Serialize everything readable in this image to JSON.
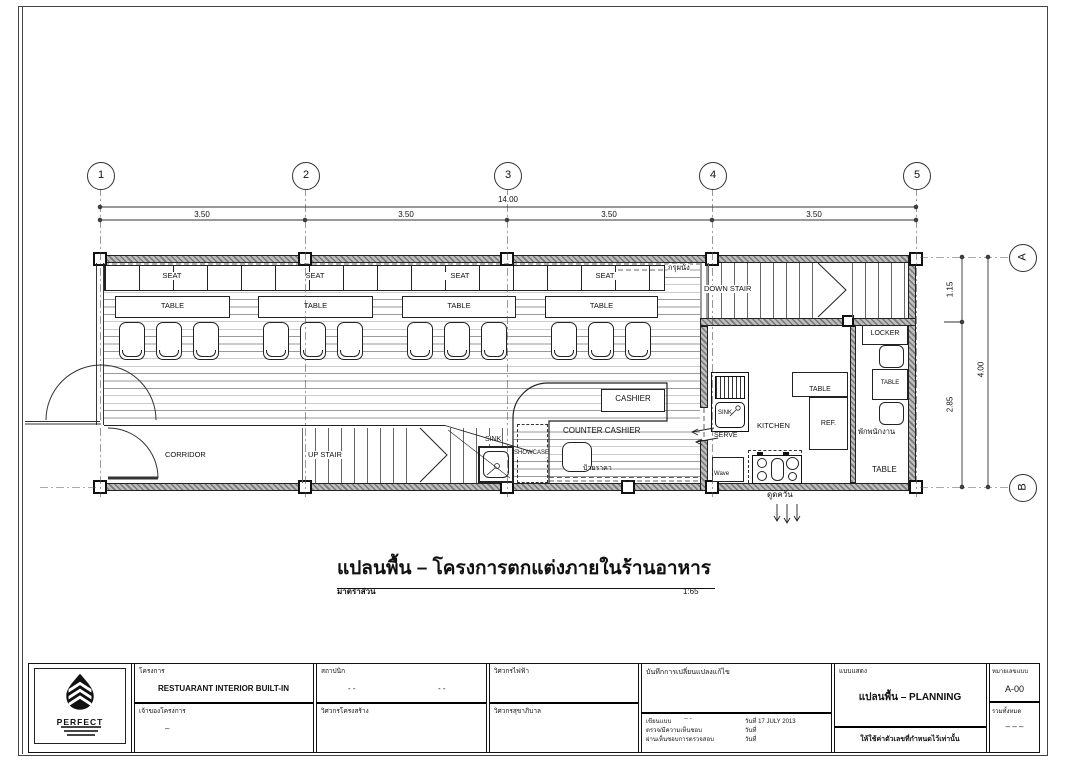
{
  "grid": {
    "cols": [
      "1",
      "2",
      "3",
      "4",
      "5"
    ],
    "rows": [
      "A",
      "B"
    ],
    "dim_total_h": "14.00",
    "dim_segments_h": [
      "3.50",
      "3.50",
      "3.50",
      "3.50"
    ],
    "dim_total_v": "4.00",
    "dim_segments_v": [
      "1.15",
      "2.85"
    ]
  },
  "plan": {
    "labels": {
      "seat": "SEAT",
      "table": "TABLE",
      "corridor": "CORRIDOR",
      "up_stair": "UP STAIR",
      "down_stair": "DOWN STAIR",
      "cashier": "CASHIER",
      "counter_cashier": "COUNTER CASHIER",
      "sink": "SINK",
      "showcase": "SHOWCASE",
      "price_sign": "ป้ายราคา",
      "wall_cladding": "กรุผนัง",
      "kitchen": "KITCHEN",
      "ref": "REF.",
      "serve": "SERVE",
      "microwave": "Wave",
      "exhaust": "ดูดควัน",
      "locker": "LOCKER",
      "staff_room": "พักพนักงาน"
    }
  },
  "caption": {
    "title": "แปลนพื้น –  โครงการตกแต่งภายในร้านอาหาร",
    "scale_label": "มาตราส่วน",
    "scale_value": "1:65"
  },
  "titleblock": {
    "logo_text": "PERFECT",
    "project_label": "โครงการ",
    "project_value": "RESTUARANT INTERIOR BUILT-IN",
    "owner_label": "เจ้าของโครงการ",
    "owner_value": "–",
    "architect_label": "สถาปนิก",
    "architect_value": "- -",
    "architect_value2": "- -",
    "structural_label": "วิศวกรโครงสร้าง",
    "electrical_label": "วิศวกรไฟฟ้า",
    "sanitary_label": "วิศวกรสุขาภิบาล",
    "revision_label": "บันทึกการเปลี่ยนแปลงแก้ไข",
    "drawn_label": "เขียนแบบ",
    "drawn_value": "-- -",
    "checked_label": "ตรวจ/มีความเห็นชอบ",
    "approved_label": "ผ่านเห็นชอบการตรวจสอบ",
    "date_label": "วันที่",
    "date_value": "17 JULY 2013",
    "shows_label": "แบบแสดง",
    "shows_value": "แปลนพื้น – PLANNING",
    "note": "ให้ใช้ค่าตัวเลขที่กำหนดไว้เท่านั้น",
    "sheet_no_label": "หมายเลขแบบ",
    "sheet_no_value": "A-00",
    "total_label": "รวมทั้งหมด",
    "total_value": "– – –"
  }
}
